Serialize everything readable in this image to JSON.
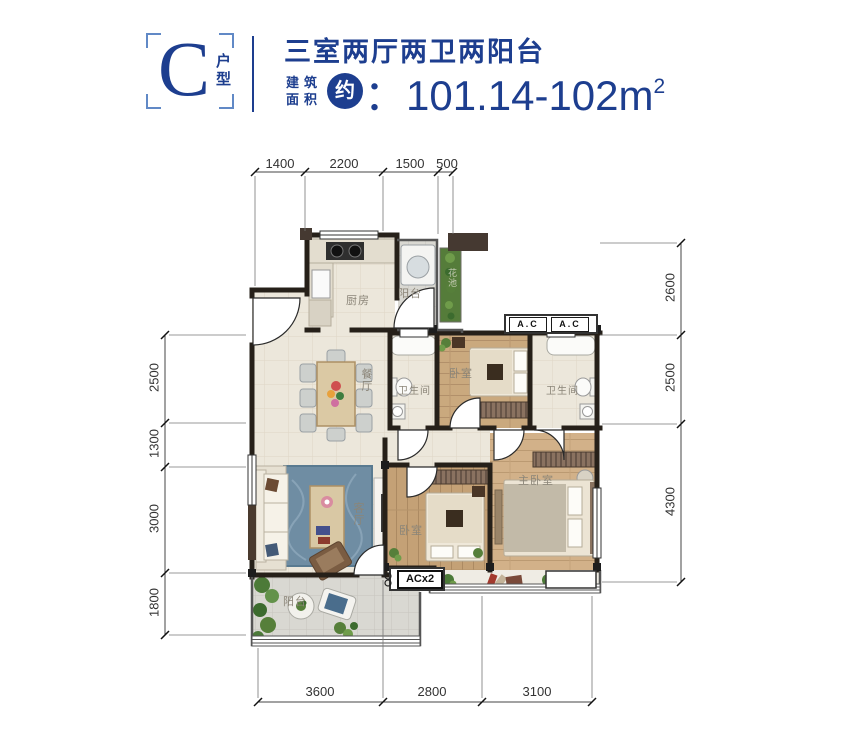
{
  "header": {
    "unit_letter": "C",
    "unit_type": "户型",
    "title": "三室两厅两卫两阳台",
    "area_label_top": "建筑",
    "area_label_bottom": "面积",
    "approx": "约",
    "area_value": "：101.14-102m",
    "area_exponent": "2",
    "accent_color": "#1d3e8f"
  },
  "dims": {
    "top": [
      "1400",
      "2200",
      "1500",
      "500"
    ],
    "left": [
      "2500",
      "1300",
      "3000",
      "1800"
    ],
    "right": [
      "2600",
      "2500",
      "4300"
    ],
    "bottom": [
      "3600",
      "2800",
      "3100"
    ]
  },
  "rooms": {
    "kitchen": "厨房",
    "balcony_top": "阳台",
    "flower_bed": "花池",
    "dining": "餐厅",
    "living": "客厅",
    "balcony_bottom": "阳台",
    "bath_left": "卫生间",
    "bath_right": "卫生间",
    "bedroom_top": "卧室",
    "bedroom_bottom": "卧室",
    "master": "主卧室"
  },
  "annotations": {
    "ac1": "A.C",
    "ac2": "A.C",
    "acx2": "ACx2"
  }
}
